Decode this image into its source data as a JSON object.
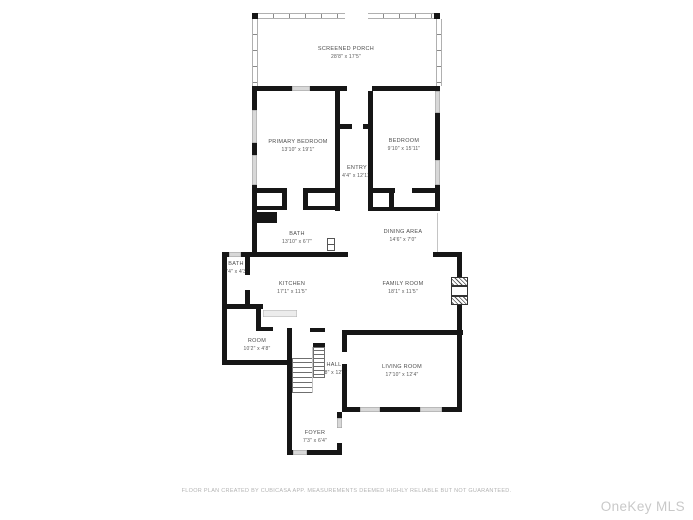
{
  "rooms": {
    "screened_porch": {
      "name": "SCREENED PORCH",
      "dims": "28'8\" x 17'5\""
    },
    "primary_bedroom": {
      "name": "PRIMARY BEDROOM",
      "dims": "13'10\" x 19'1\""
    },
    "bedroom": {
      "name": "BEDROOM",
      "dims": "9'10\" x 15'11\""
    },
    "entry": {
      "name": "ENTRY",
      "dims": "4'4\" x 12'11\""
    },
    "bath": {
      "name": "BATH",
      "dims": "13'10\" x 6'7\""
    },
    "dining_area": {
      "name": "DINING AREA",
      "dims": "14'6\" x 7'0\""
    },
    "bath_2": {
      "name": "BATH",
      "dims": "4'4\" x 4'3\""
    },
    "kitchen": {
      "name": "KITCHEN",
      "dims": "17'1\" x 11'5\""
    },
    "family_room": {
      "name": "FAMILY ROOM",
      "dims": "18'1\" x 11'5\""
    },
    "room": {
      "name": "ROOM",
      "dims": "10'2\" x 4'8\""
    },
    "hall": {
      "name": "HALL",
      "dims": "4'8\" x 12'8\""
    },
    "living_room": {
      "name": "LIVING ROOM",
      "dims": "17'10\" x 12'4\""
    },
    "foyer": {
      "name": "FOYER",
      "dims": "7'3\" x 6'4\""
    }
  },
  "footer": {
    "disclaimer": "FLOOR PLAN CREATED BY CUBICASA APP. MEASUREMENTS DEEMED HIGHLY RELIABLE BUT NOT GUARANTEED."
  },
  "watermark": {
    "text": "OneKey MLS"
  },
  "colors": {
    "wall": "#161616",
    "window_fill": "#d8d8d8",
    "screen_wall_outline": "#b0b0b0",
    "label_text": "#4d4d4d",
    "disclaimer_text": "#b3b3b3",
    "watermark_text": "#c9c9c9",
    "background": "#ffffff"
  }
}
